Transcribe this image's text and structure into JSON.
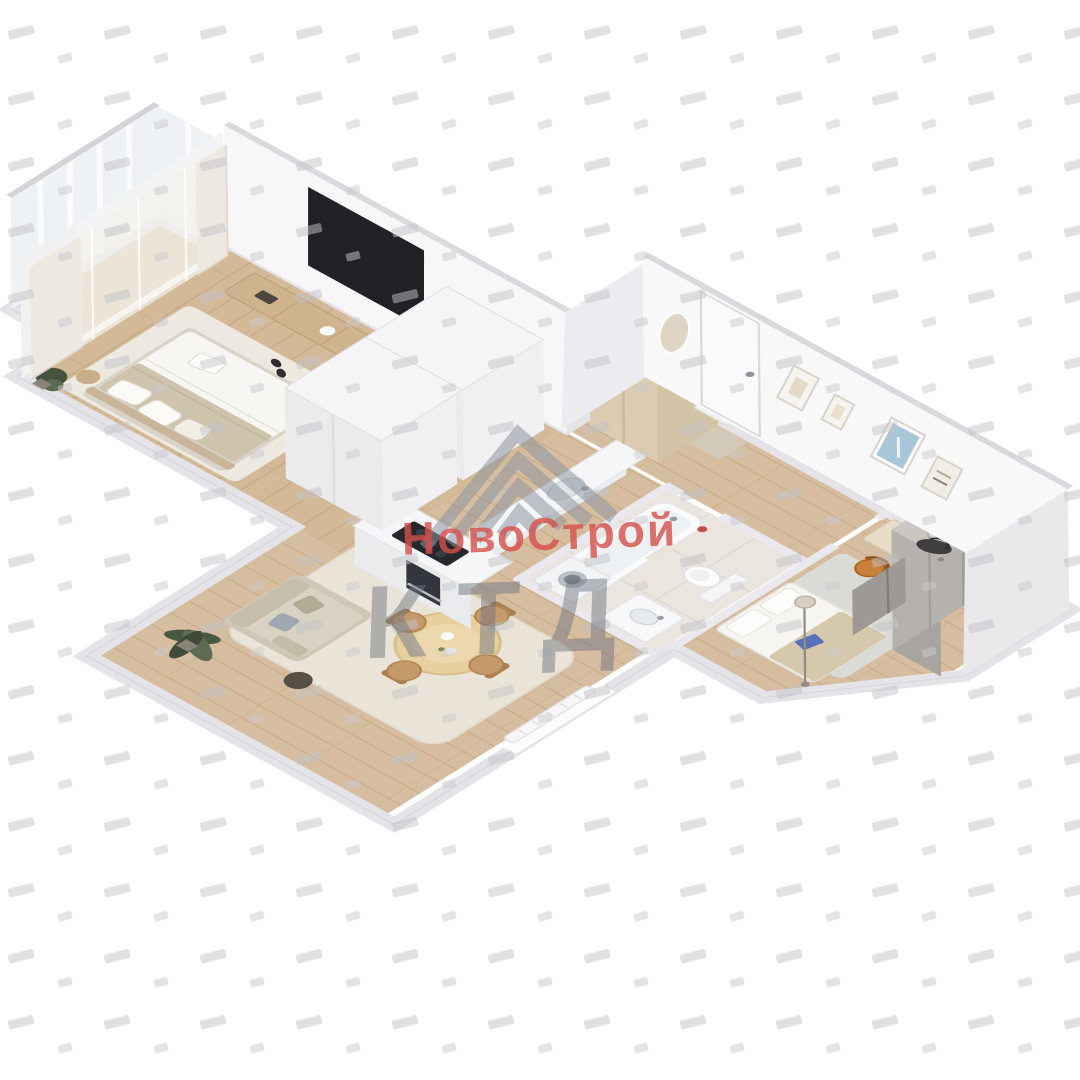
{
  "image_type": "3d-isometric-floor-plan-render",
  "watermark": {
    "brand": "НовоСтрой",
    "letters": "КТД",
    "brand_color": "#d64f4a",
    "letters_color": "#6e7480",
    "logo_icon": "nested-chevron-roof-icon",
    "pattern_icon": "diagonal-dash-pattern"
  },
  "palette": {
    "background": "#ffffff",
    "wall_band": "#e4e4e8",
    "wall_face": "#f7f7f8",
    "wall_cap": "#d9d9de",
    "wood_floor": "#d5bc9e",
    "wood_floor_line": "#c6aa85",
    "tile_floor": "#eae5df",
    "rug_cream": "#ebe6db",
    "rug_gray": "#dadad6",
    "sofa": "#d9d2c3",
    "bed_blanket": "#cec3ad",
    "table_wood": "#e7cf9f",
    "cooktop": "#26282d",
    "tv": "#202227",
    "wardrobe_wood": "#dbcbb0",
    "wardrobe_gray": "#b5b2ae",
    "chair_orange": "#c9803a",
    "picture_blue": "#a9c6d8",
    "plant_green": "#4a5742",
    "accent_red": "#c0504b"
  }
}
